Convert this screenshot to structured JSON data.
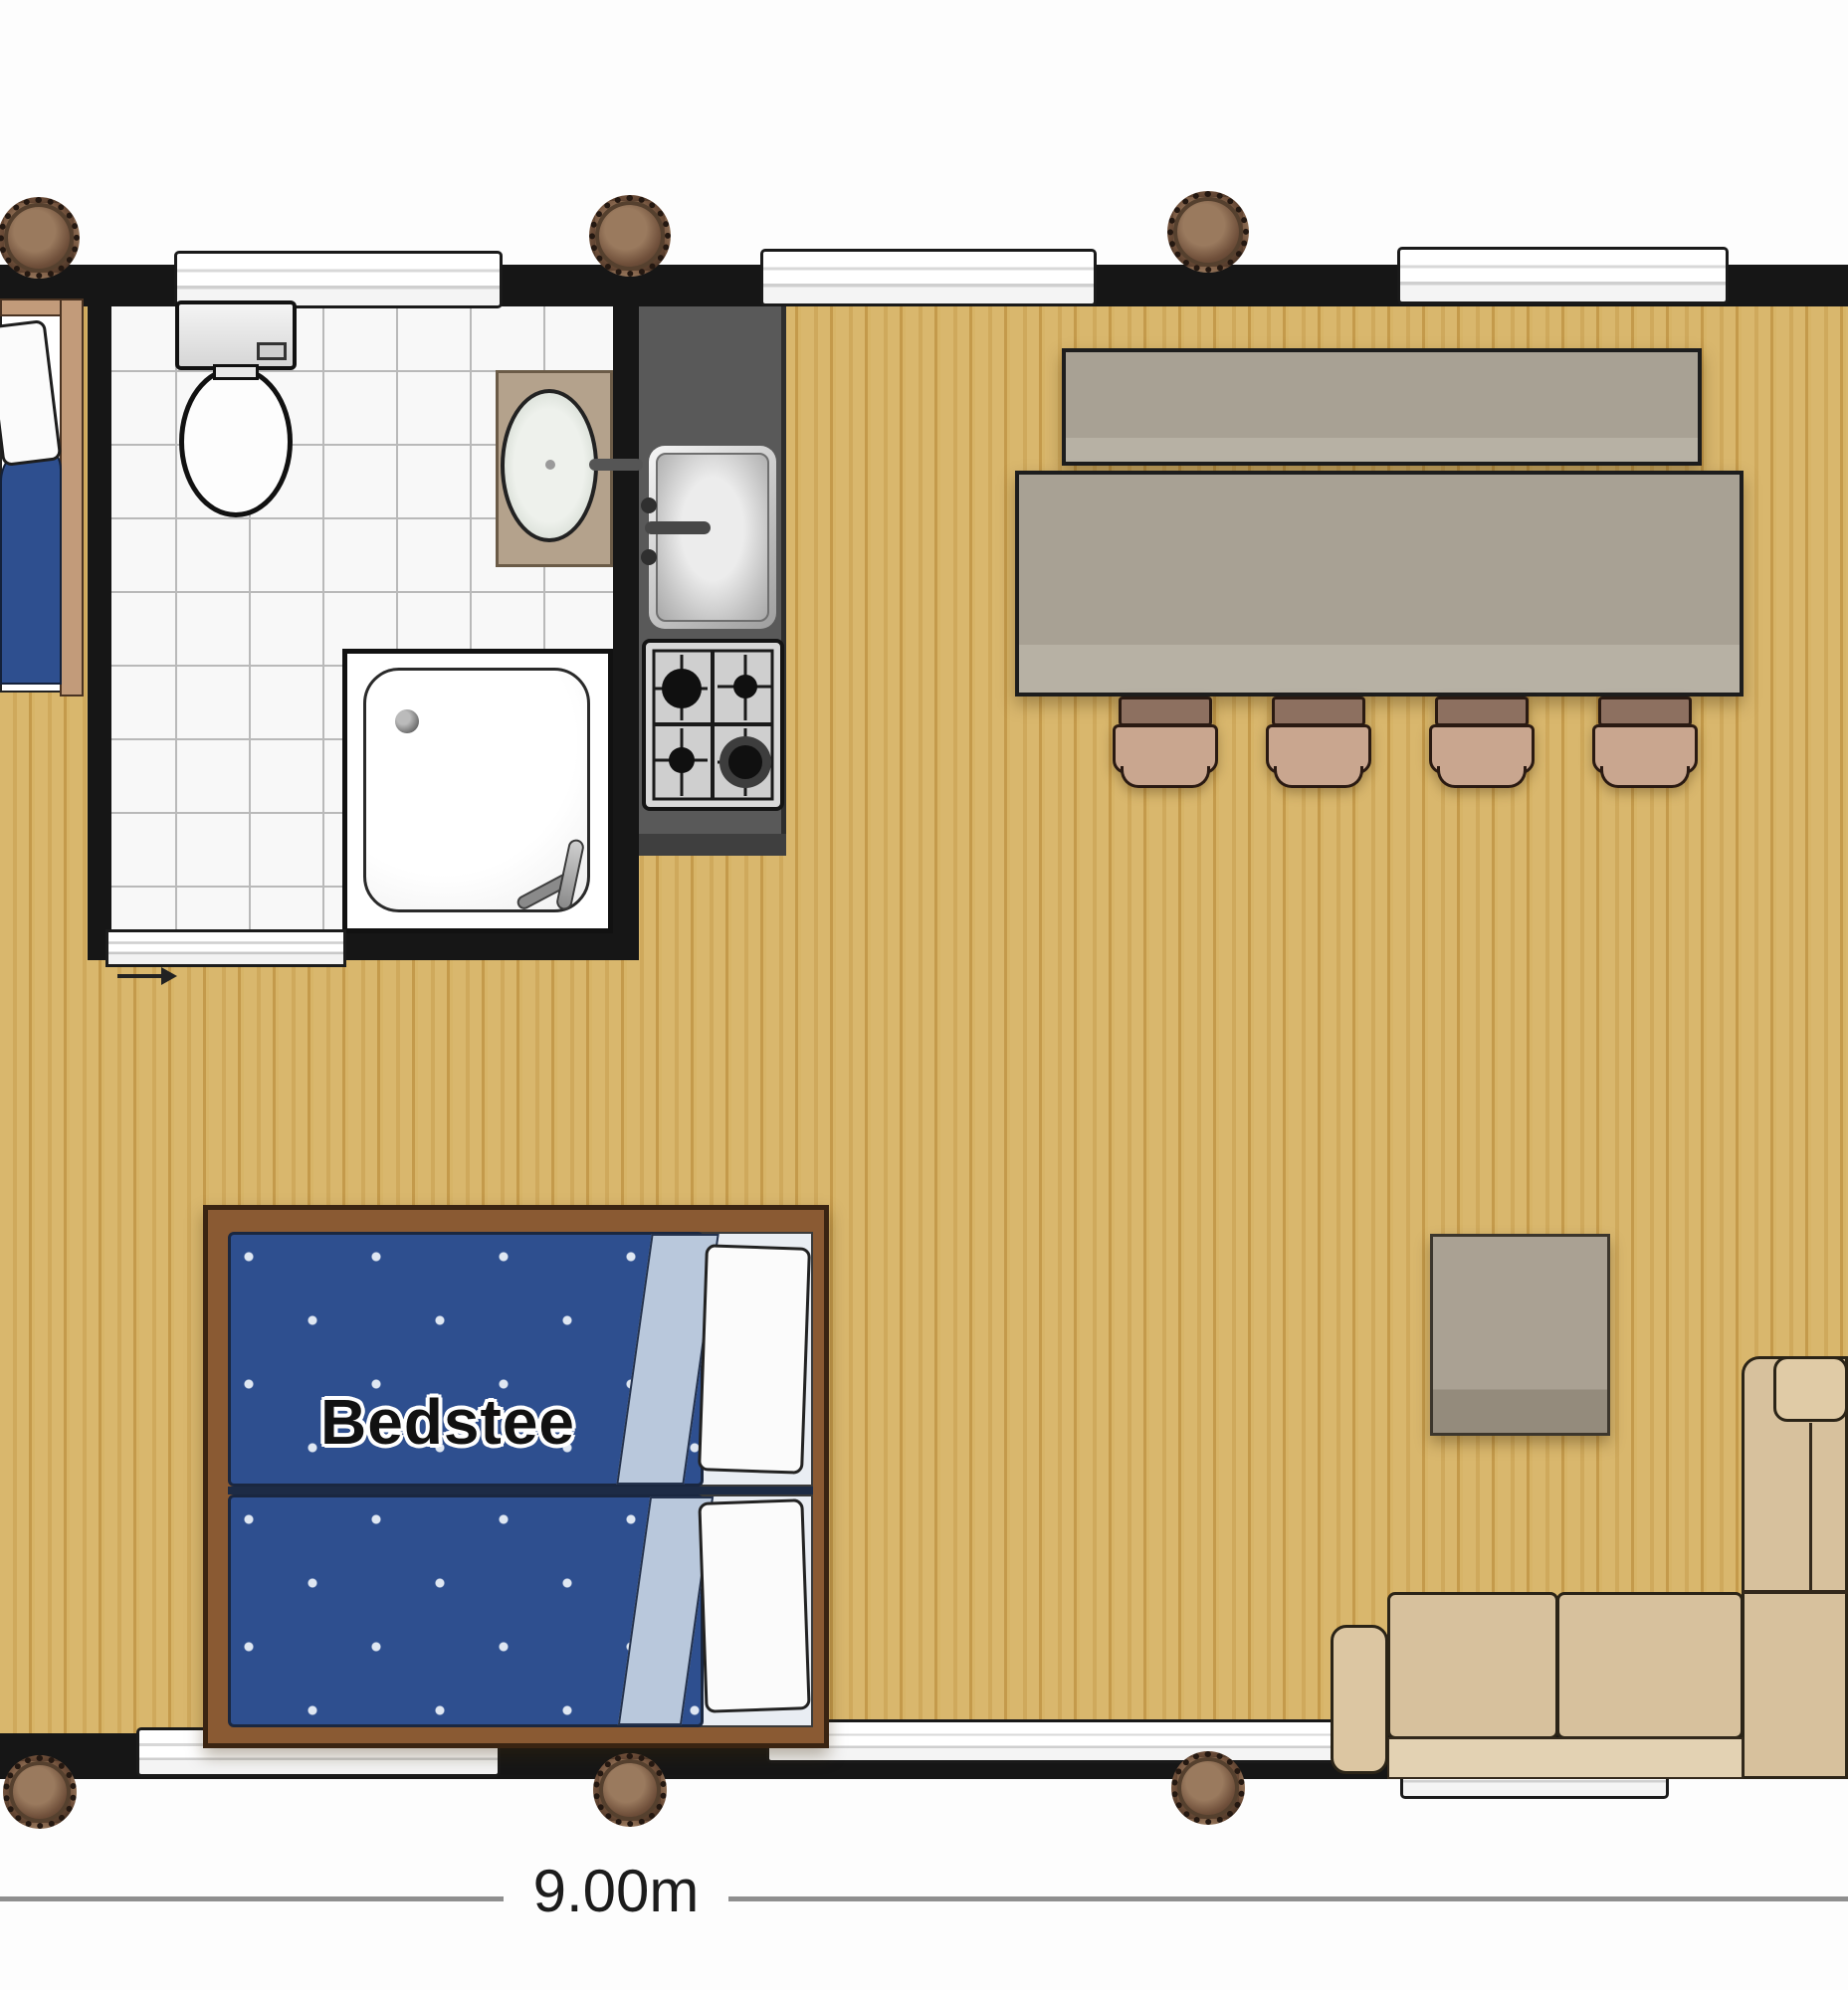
{
  "plan": {
    "labels": {
      "box_bed": "Bedstee",
      "width_dimension": "9.00m"
    },
    "colors": {
      "background": "#ffffff",
      "wall": "#161616",
      "wood_floor": "#d8b66c",
      "wood_streak": "#c49a4b",
      "bath_tile": "#f8f8f8",
      "tile_grout": "#b9b9b9",
      "kitchen_counter": "#595959",
      "stainless_steel": "#d6d6d6",
      "table_wood": "#a8a194",
      "chair_seat": "#c9a68f",
      "sofa_beige": "#d7c19d",
      "coffee_table": "#aaa193",
      "bed_blue": "#2e4f8f",
      "bed_fold_blue": "#b9c8dc",
      "pillow_white": "#fbfbfb",
      "bed_frame_brown": "#8a5a33",
      "post_brown": "#6f4f3a",
      "dimension_line": "#8f8f8f"
    },
    "rooms": [
      {
        "name": "bathroom",
        "fixtures": [
          "toilet",
          "bathroom-sink",
          "shower",
          "sliding-door"
        ]
      },
      {
        "name": "kitchen",
        "fixtures": [
          "kitchen-sink",
          "gas-stove-4-burners",
          "counter"
        ]
      },
      {
        "name": "living-dining",
        "fixtures": [
          "dining-bench",
          "dining-table",
          "dining-chair",
          "dining-chair",
          "dining-chair",
          "dining-chair",
          "coffee-table",
          "corner-sofa",
          "box-bed",
          "single-bed"
        ]
      }
    ],
    "windows": {
      "top_wall": 3,
      "bottom_wall": 3
    },
    "structural_posts": 6
  }
}
